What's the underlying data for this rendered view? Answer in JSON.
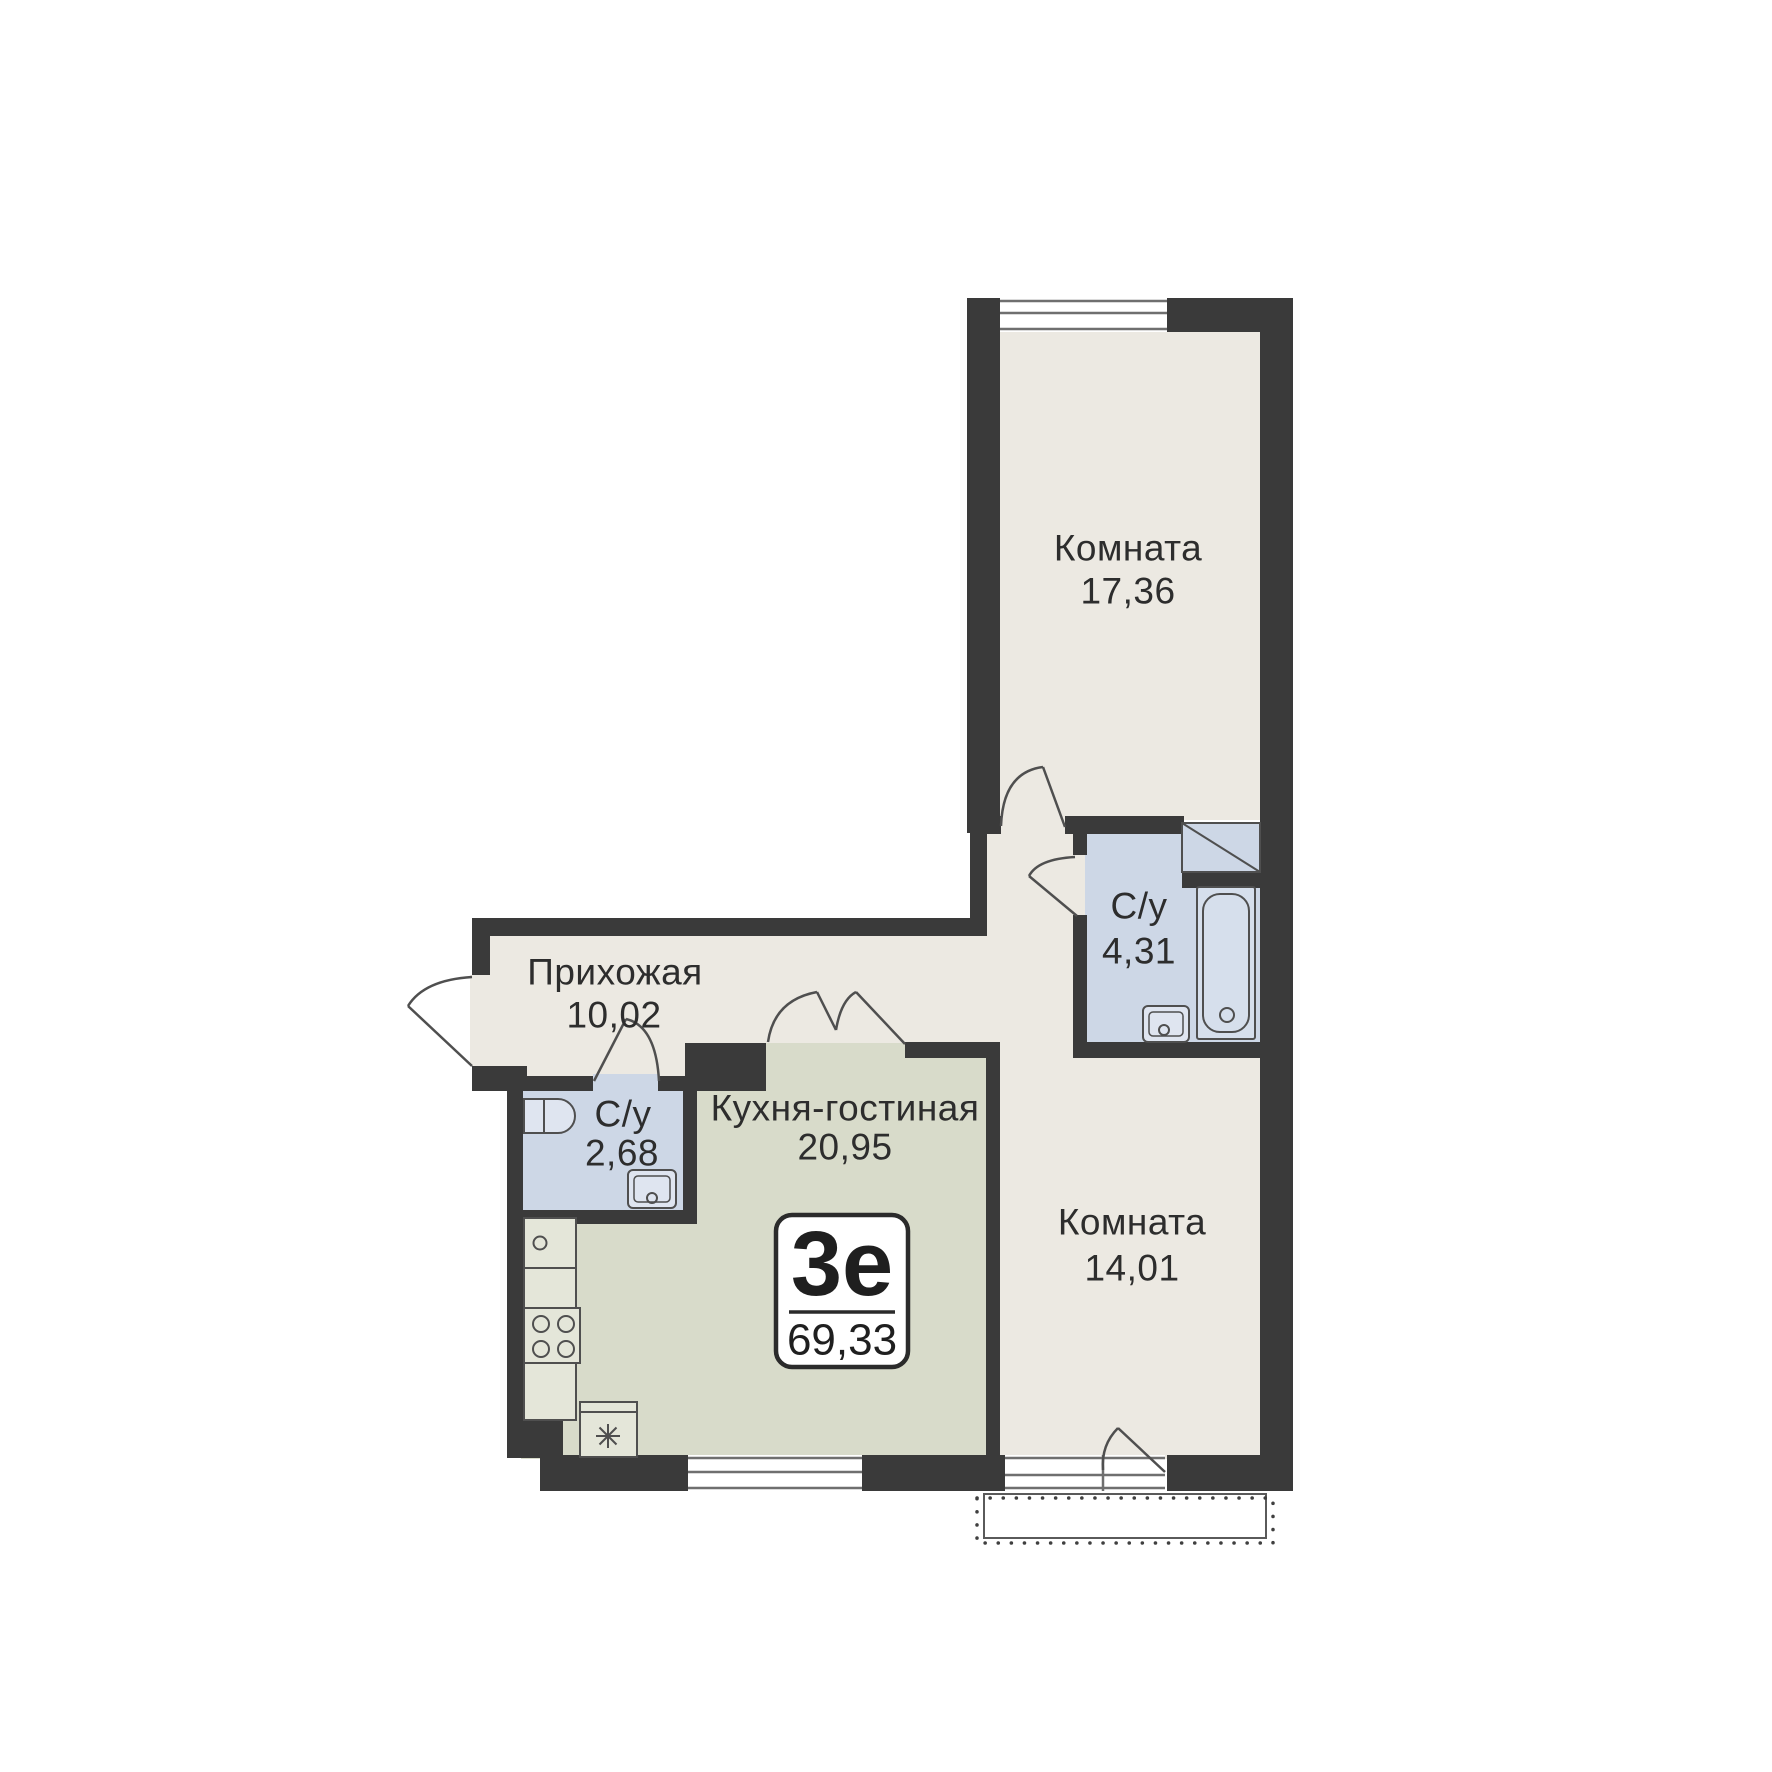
{
  "floor_plan": {
    "badge": {
      "layout_code": "3е",
      "total_area": "69,33"
    },
    "rooms": [
      {
        "name": "Комната",
        "area": "17,36"
      },
      {
        "name": "С/у",
        "area": "4,31"
      },
      {
        "name": "Прихожая",
        "area": "10,02"
      },
      {
        "name": "С/у",
        "area": "2,68"
      },
      {
        "name": "Кухня-гостиная",
        "area": "20,95"
      },
      {
        "name": "Комната",
        "area": "14,01"
      }
    ],
    "fixture_icons": [
      "bathtub-icon",
      "sink-icon",
      "toilet-icon",
      "stove-burners-icon",
      "washing-machine-icon",
      "ventilation-shaft-icon",
      "window-icon",
      "door-arc-icon",
      "balcony-outline-icon"
    ],
    "colors": {
      "wall": "#3a3a3a",
      "room_fill": "#ece9e2",
      "kitchen_fill": "#d8dbca",
      "bathroom_fill": "#cdd7e6",
      "background": "#ffffff"
    }
  }
}
